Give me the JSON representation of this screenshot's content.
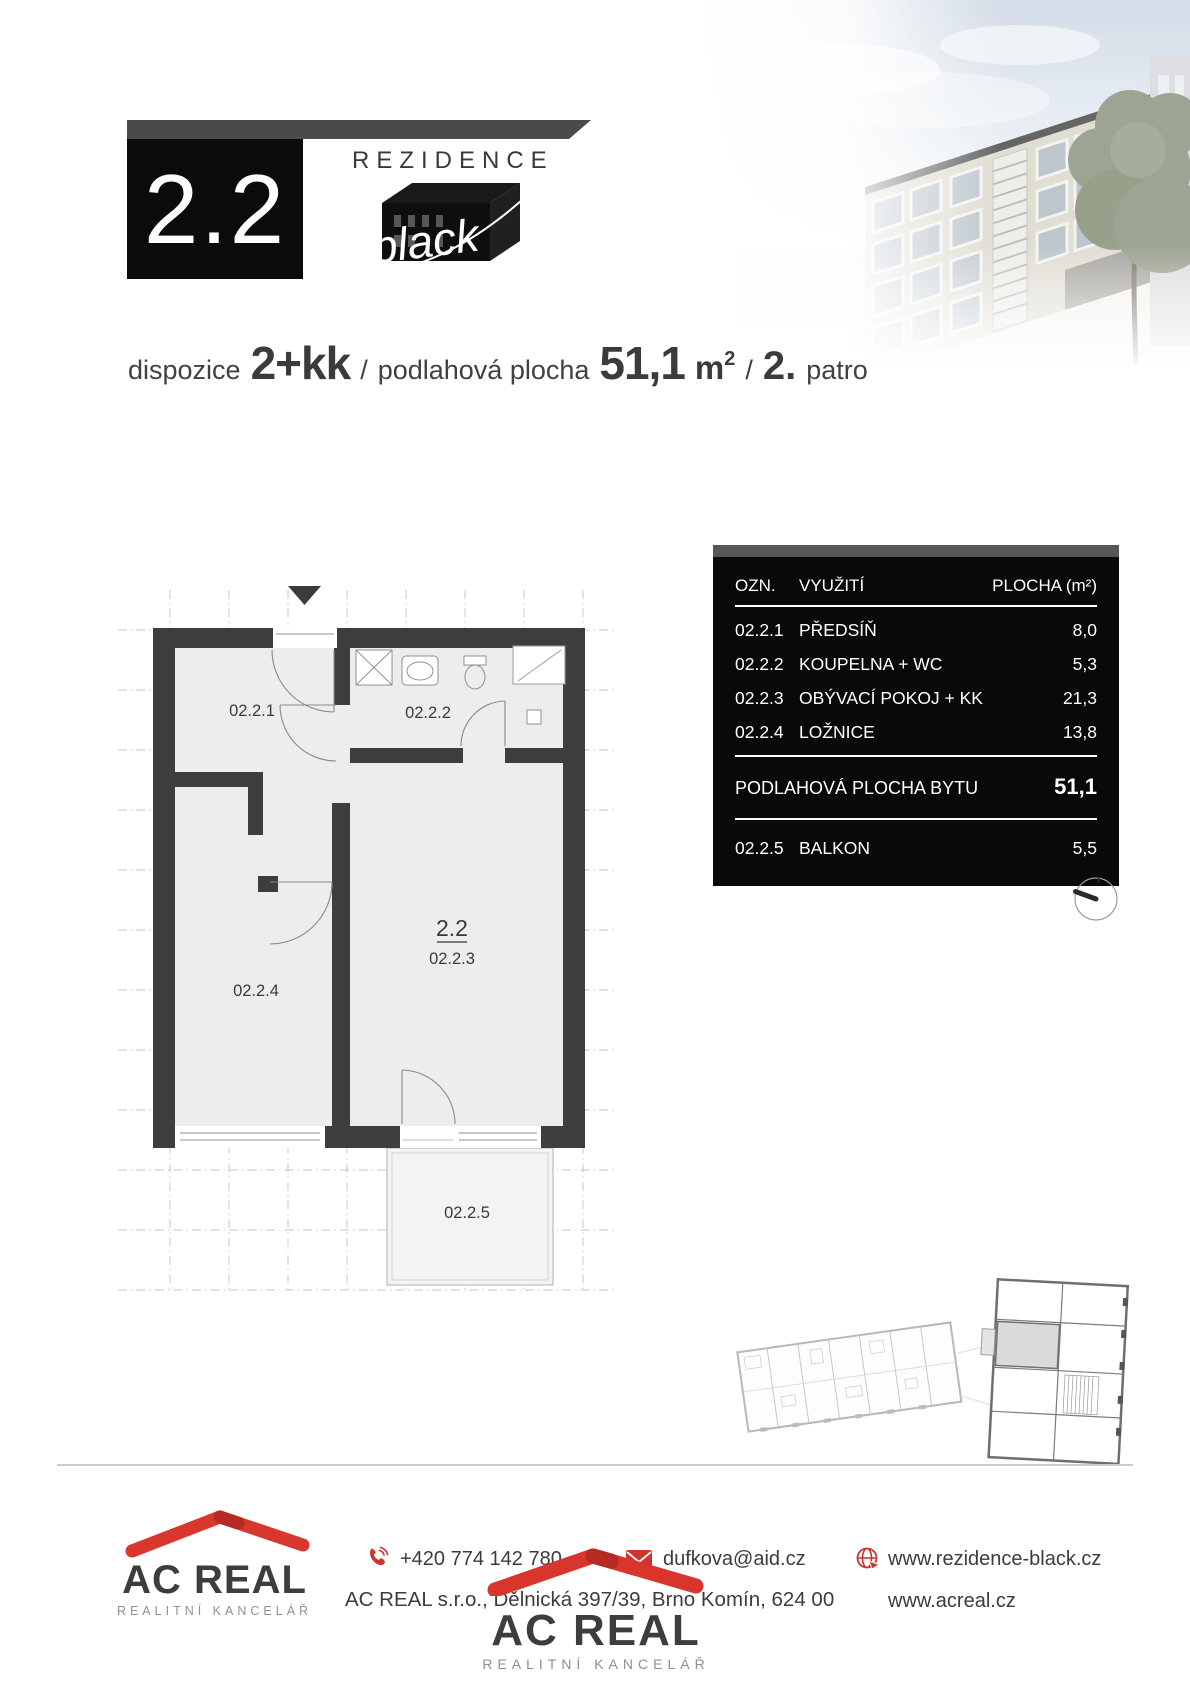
{
  "header": {
    "unit_number": "2.2",
    "brand_line": "REZIDENCE",
    "brand_script": "black"
  },
  "summary": {
    "disposition_label": "dispozice",
    "disposition_value": "2+kk",
    "separator1": "/",
    "area_label": "podlahová plocha",
    "area_value": "51,1",
    "area_unit": "m",
    "area_unit_exponent": "2",
    "separator2": "/",
    "floor_value": "2.",
    "floor_label": "patro"
  },
  "floorplan": {
    "labels": {
      "hall": "02.2.1",
      "bathroom": "02.2.2",
      "unit": "2.2",
      "living": "02.2.3",
      "bedroom": "02.2.4",
      "balcony": "02.2.5"
    }
  },
  "area_table": {
    "columns": {
      "designation": "OZN.",
      "usage": "VYUŽITÍ",
      "area": "PLOCHA (m²)"
    },
    "rows": [
      {
        "designation": "02.2.1",
        "usage": "PŘEDSÍŇ",
        "area": "8,0"
      },
      {
        "designation": "02.2.2",
        "usage": "KOUPELNA + WC",
        "area": "5,3"
      },
      {
        "designation": "02.2.3",
        "usage": "OBÝVACÍ POKOJ + KK",
        "area": "21,3"
      },
      {
        "designation": "02.2.4",
        "usage": "LOŽNICE",
        "area": "13,8"
      }
    ],
    "total_row": {
      "label": "PODLAHOVÁ PLOCHA BYTU",
      "area": "51,1"
    },
    "balcony_row": {
      "designation": "02.2.5",
      "usage": "BALKON",
      "area": "5,5"
    }
  },
  "footer": {
    "agency_logo": {
      "name": "AC REAL",
      "tagline": "REALITNÍ KANCELÁŘ"
    },
    "phone": "+420 774 142 780",
    "email": "dufkova@aid.cz",
    "project_website": "www.rezidence-black.cz",
    "company_address": "AC REAL s.r.o., Dělnická 397/39, Brno Komín, 624 00",
    "company_website": "www.acreal.cz",
    "center_logo": {
      "name": "AC REAL",
      "tagline": "REALITNÍ KANCELÁŘ"
    }
  },
  "icons": {
    "phone": "phone-icon",
    "email": "envelope-icon",
    "website": "globe-icon",
    "compass": "compass-icon",
    "entrance": "entrance-arrow-icon"
  },
  "colors": {
    "accent_red": "#d0342c",
    "wall_dark": "#3d3f3e",
    "table_background": "#090909",
    "header_bar_gray": "#4a4a4a",
    "room_fill": "#ecedec"
  }
}
